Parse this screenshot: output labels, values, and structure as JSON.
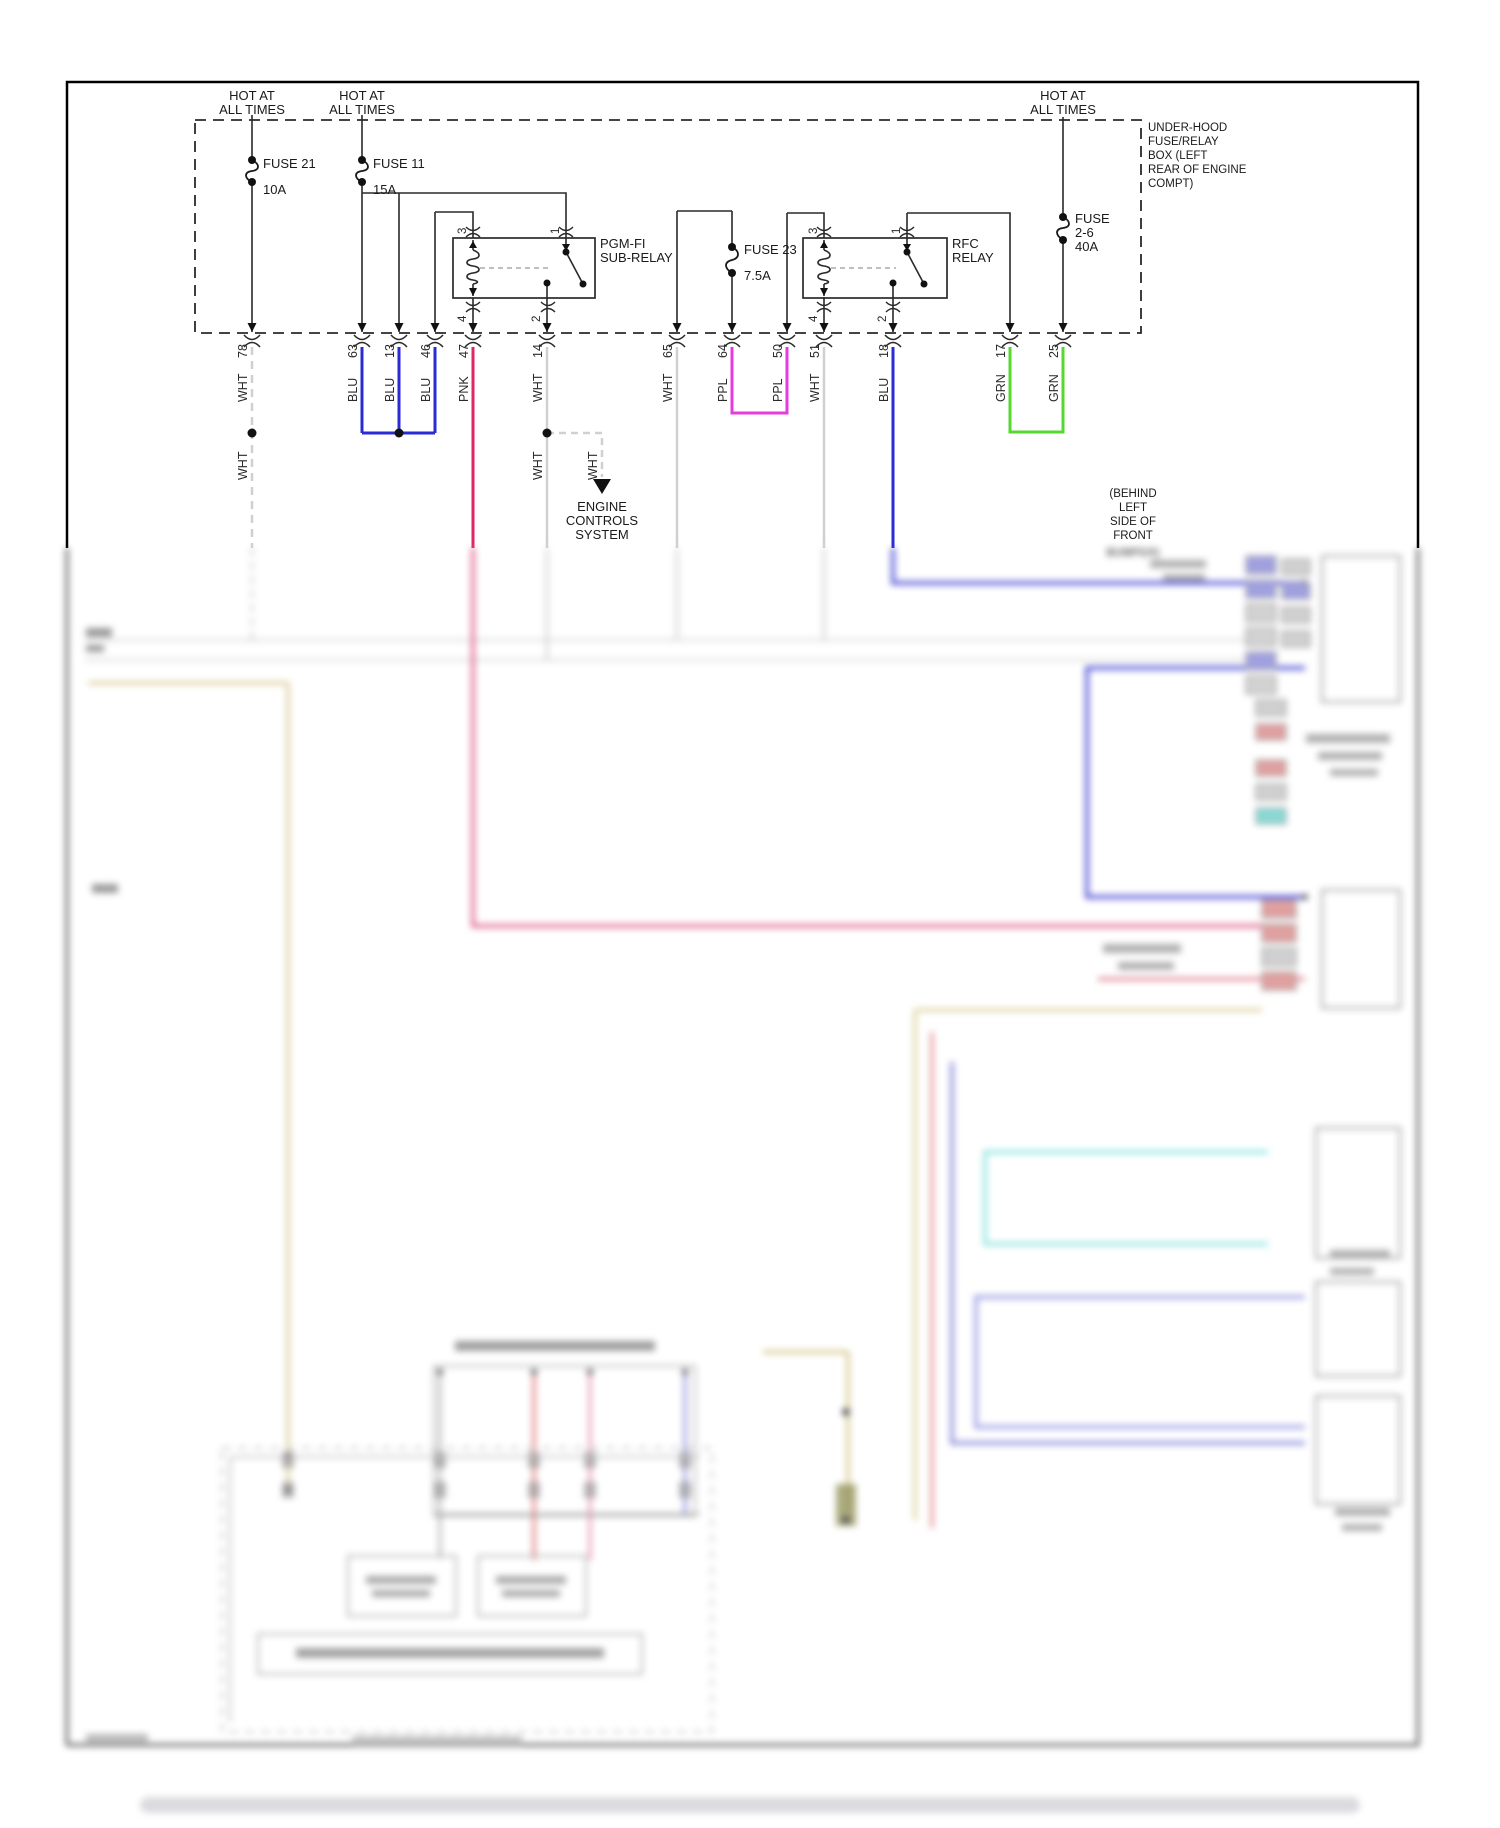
{
  "diagram": {
    "power_label": {
      "line1": "HOT AT",
      "line2": "ALL TIMES"
    },
    "fuse_box_title": {
      "lines": [
        "UNDER-HOOD",
        "FUSE/RELAY",
        "BOX (LEFT",
        "REAR OF ENGINE",
        "COMPT)"
      ]
    },
    "fuses": [
      {
        "label": "FUSE 21",
        "rating": "10A"
      },
      {
        "label": "FUSE 11",
        "rating": "15A"
      },
      {
        "label": "FUSE 23",
        "rating": "7.5A"
      },
      {
        "label": "FUSE",
        "label2": "2-6",
        "rating": "40A"
      }
    ],
    "relays": [
      {
        "line1": "PGM-FI",
        "line2": "SUB-RELAY"
      },
      {
        "line1": "RFC",
        "line2": "RELAY"
      }
    ],
    "relay_pins": [
      "3",
      "1",
      "4",
      "2"
    ],
    "circuits": [
      {
        "number": "78",
        "color": "WHT"
      },
      {
        "number": "63",
        "color": "BLU"
      },
      {
        "number": "13",
        "color": "BLU"
      },
      {
        "number": "46",
        "color": "BLU"
      },
      {
        "number": "47",
        "color": "PNK"
      },
      {
        "number": "14",
        "color": "WHT"
      },
      {
        "number": "65",
        "color": "WHT"
      },
      {
        "number": "64",
        "color": "PPL"
      },
      {
        "number": "50",
        "color": "PPL"
      },
      {
        "number": "51",
        "color": "WHT"
      },
      {
        "number": "18",
        "color": "BLU"
      },
      {
        "number": "17",
        "color": "GRN"
      },
      {
        "number": "25",
        "color": "GRN"
      }
    ],
    "splice_labels": [
      "WHT",
      "WHT",
      "WHT"
    ],
    "destination": {
      "lines": [
        "ENGINE",
        "CONTROLS",
        "SYSTEM"
      ]
    },
    "location_note": {
      "lines": [
        "(BEHIND",
        "LEFT",
        "SIDE OF",
        "FRONT",
        "BUMPER)"
      ]
    },
    "wire_color_hex": {
      "WHT": "#cfcfcf",
      "BLU": "#2b2bd6",
      "PNK": "#de2766",
      "PPL": "#e63cde",
      "GRN": "#55d830"
    }
  }
}
